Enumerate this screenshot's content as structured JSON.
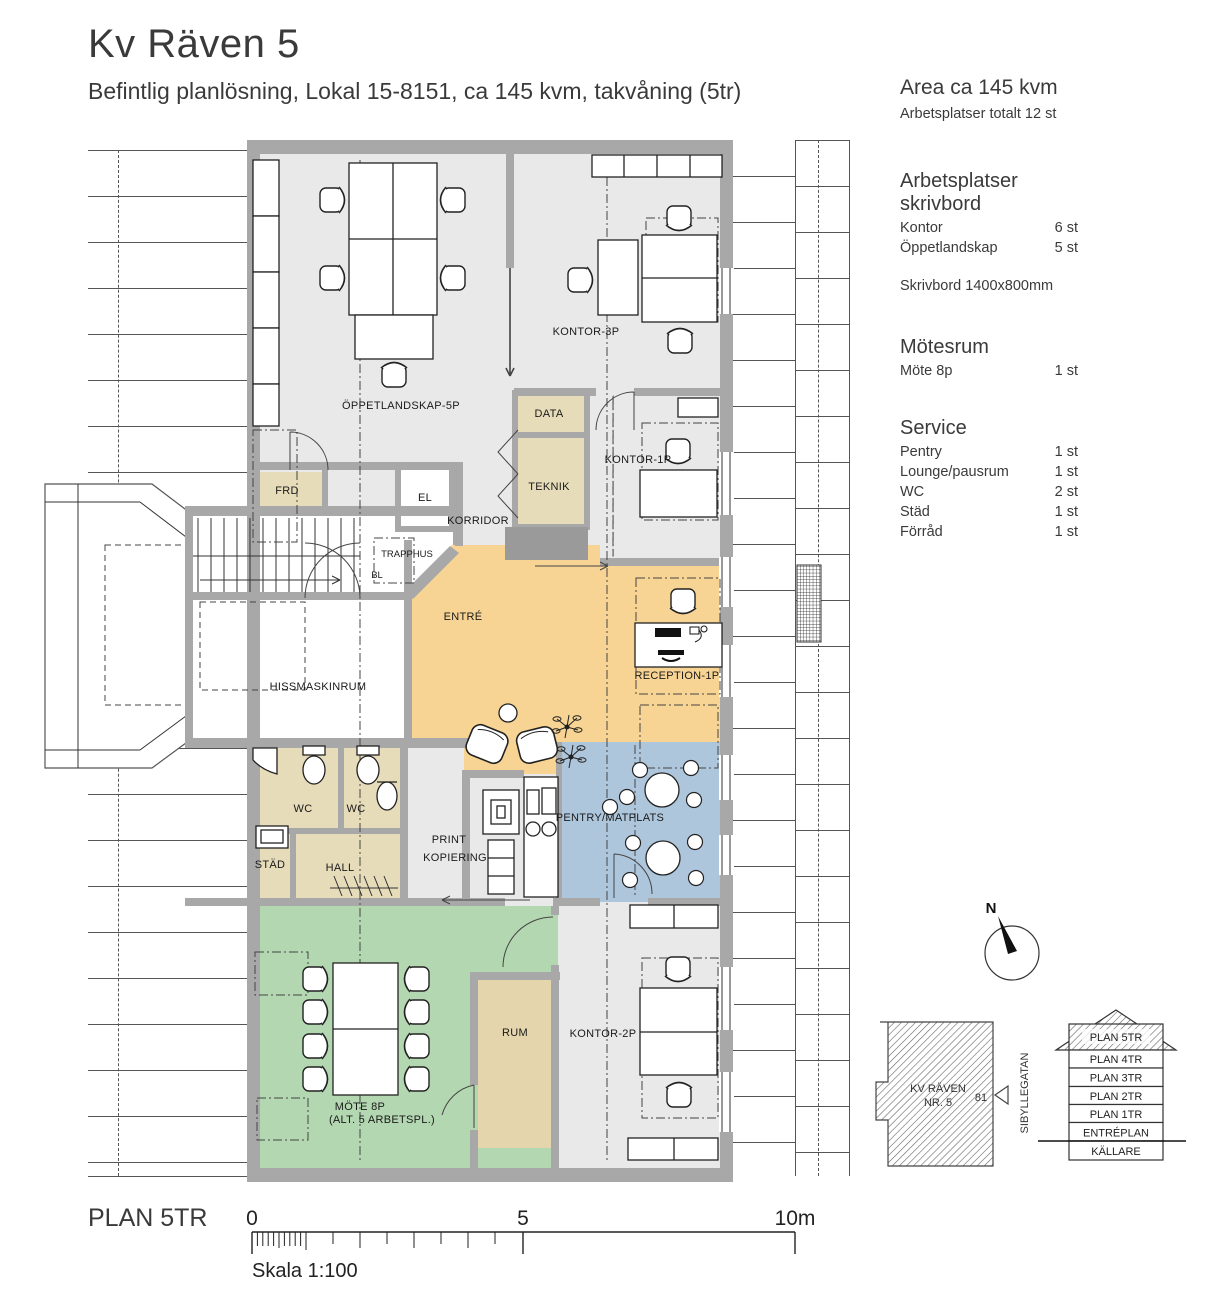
{
  "title": "Kv Räven 5",
  "subtitle": "Befintlig planlösning, Lokal 15-8151, ca 145 kvm, takvåning (5tr)",
  "info_panel": {
    "area_heading": "Area ca 145 kvm",
    "area_sub": "Arbetsplatser totalt 12 st",
    "sections": [
      {
        "heading": "Arbetsplatser skrivbord",
        "rows": [
          {
            "label": "Kontor",
            "value": "6 st"
          },
          {
            "label": "Öppetlandskap",
            "value": "5 st"
          }
        ],
        "note": "Skrivbord 1400x800mm"
      },
      {
        "heading": "Mötesrum",
        "rows": [
          {
            "label": "Möte 8p",
            "value": "1 st"
          }
        ]
      },
      {
        "heading": "Service",
        "rows": [
          {
            "label": "Pentry",
            "value": "1 st"
          },
          {
            "label": "Lounge/pausrum",
            "value": "1 st"
          },
          {
            "label": "WC",
            "value": "2 st"
          },
          {
            "label": "Städ",
            "value": "1 st"
          },
          {
            "label": "Förråd",
            "value": "1 st"
          }
        ]
      }
    ]
  },
  "plan": {
    "north": "N",
    "rooms": {
      "oppetlandskap": "ÖPPETLANDSKAP-5P",
      "kontor3p": "KONTOR-3P",
      "data": "DATA",
      "teknik": "TEKNIK",
      "kontor1p": "KONTOR-1P",
      "el": "EL",
      "frd": "FRD",
      "korridor": "KORRIDOR",
      "trapphus": "TRAPPHUS",
      "bl": "BL",
      "hissmaskinrum": "HISSMASKINRUM",
      "entre": "ENTRÉ",
      "reception": "RECEPTION-1P",
      "wc1": "WC",
      "wc2": "WC",
      "stad": "STÄD",
      "hall": "HALL",
      "print1": "PRINT",
      "print2": "KOPIERING",
      "pentry": "PENTRY/MATPLATS",
      "mote1": "MÖTE 8P",
      "mote2": "(ALT. 5 ARBETSPL.)",
      "rum": "RUM",
      "kontor2p": "KONTOR-2P"
    }
  },
  "footer": {
    "plan_label": "PLAN 5TR",
    "scale_ticks": [
      "0",
      "5",
      "10m"
    ],
    "scale_text": "Skala 1:100"
  },
  "site": {
    "name1": "KV RÄVEN",
    "name2": "NR. 5",
    "number": "81",
    "street": "SIBYLLEGATAN"
  },
  "section_diagram": {
    "levels": [
      "PLAN 5TR",
      "PLAN 4TR",
      "PLAN 3TR",
      "PLAN 2TR",
      "PLAN 1TR",
      "ENTRÉPLAN",
      "KÄLLARE"
    ]
  },
  "colors": {
    "entre_zone": "#f7d493",
    "pentry_zone": "#aec6dc",
    "meeting_zone": "#b3d7b0",
    "service_beige": "#e7dcba",
    "rum_beige": "#e5d5ac",
    "wall_gray": "#a8a8a8",
    "room_gray": "#e9e9e9"
  }
}
